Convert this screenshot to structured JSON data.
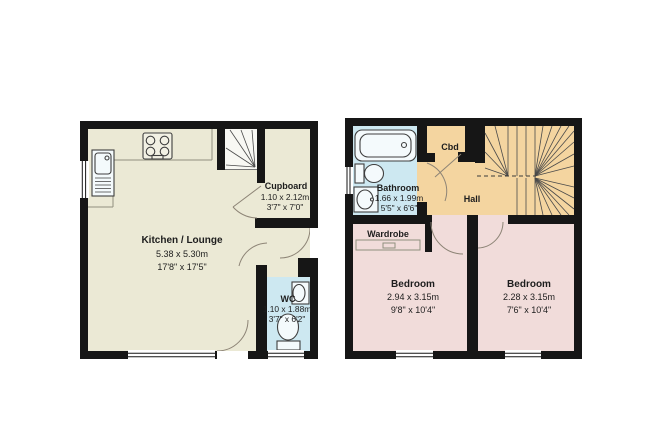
{
  "colors": {
    "wall": "#161616",
    "lounge": "#ebe9d5",
    "wc_bath": "#cde8f1",
    "hall": "#f4d5a0",
    "bedroom": "#f1dcda",
    "stairs_gf": "#f8f8f3",
    "window": "#ffffff"
  },
  "ground_floor": {
    "kitchen_lounge": {
      "name": "Kitchen / Lounge",
      "metric": "5.38 x 5.30m",
      "imperial": "17'8\" x 17'5\""
    },
    "cupboard": {
      "name": "Cupboard",
      "metric": "1.10 x 2.12m",
      "imperial": "3'7\" x 7'0\""
    },
    "wc": {
      "name": "WC",
      "metric": "1.10 x 1.88m",
      "imperial": "3'7\" x 6'2\""
    }
  },
  "first_floor": {
    "bathroom": {
      "name": "Bathroom",
      "metric": "1.66 x 1.99m",
      "imperial": "5'5\" x 6'6\""
    },
    "cbd": {
      "name": "Cbd"
    },
    "hall": {
      "name": "Hall"
    },
    "wardrobe": {
      "name": "Wardrobe"
    },
    "bedroom1": {
      "name": "Bedroom",
      "metric": "2.94 x 3.15m",
      "imperial": "9'8\" x 10'4\""
    },
    "bedroom2": {
      "name": "Bedroom",
      "metric": "2.28 x 3.15m",
      "imperial": "7'6\" x 10'4\""
    }
  },
  "fixtures": [
    "sink-icon",
    "hob-icon",
    "stairs-icon",
    "toilet-icon",
    "basin-icon",
    "bathtub-icon",
    "wardrobe-rail-icon",
    "door-arc-icon",
    "window-icon"
  ]
}
